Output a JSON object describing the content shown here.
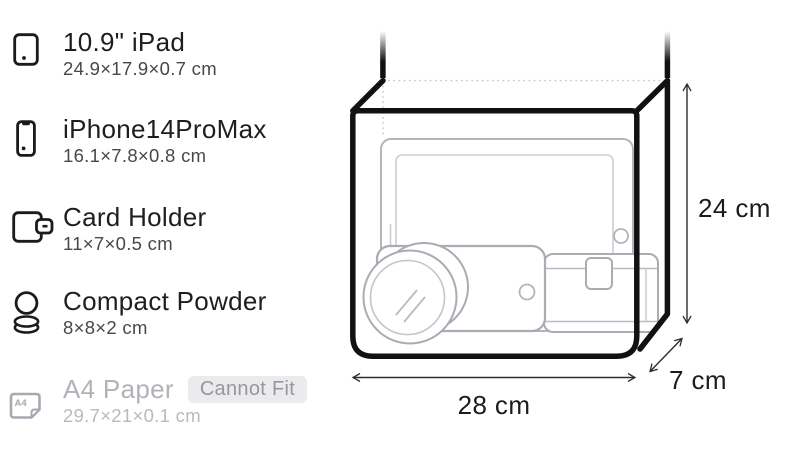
{
  "item_list": {
    "items": [
      {
        "name": "10.9\" iPad",
        "dims": "24.9×17.9×0.7 cm",
        "icon": "tablet-icon",
        "fits": true
      },
      {
        "name": "iPhone14ProMax",
        "dims": "16.1×7.8×0.8 cm",
        "icon": "smartphone-icon",
        "fits": true
      },
      {
        "name": "Card Holder",
        "dims": "11×7×0.5 cm",
        "icon": "wallet-icon",
        "fits": true
      },
      {
        "name": "Compact Powder",
        "dims": "8×8×2 cm",
        "icon": "powder-compact-icon",
        "fits": true
      },
      {
        "name": "A4 Paper",
        "dims": "29.7×21×0.1 cm",
        "icon": "a4-paper-icon",
        "fits": false,
        "badge": "Cannot Fit"
      }
    ],
    "a4_icon_label": "A4"
  },
  "bag_diagram": {
    "height_label": "24 cm",
    "width_label": "28 cm",
    "depth_label": "7 cm"
  },
  "colors": {
    "bag_outline": "#111111",
    "item_outline": "#a9acb2",
    "dotted_hidden_edge": "#c3c3c6",
    "text_primary": "#1e1e20",
    "text_secondary": "#48484a",
    "text_disabled": "#b2b2b8",
    "badge_bg": "#ebebee",
    "badge_text": "#9696a0"
  }
}
